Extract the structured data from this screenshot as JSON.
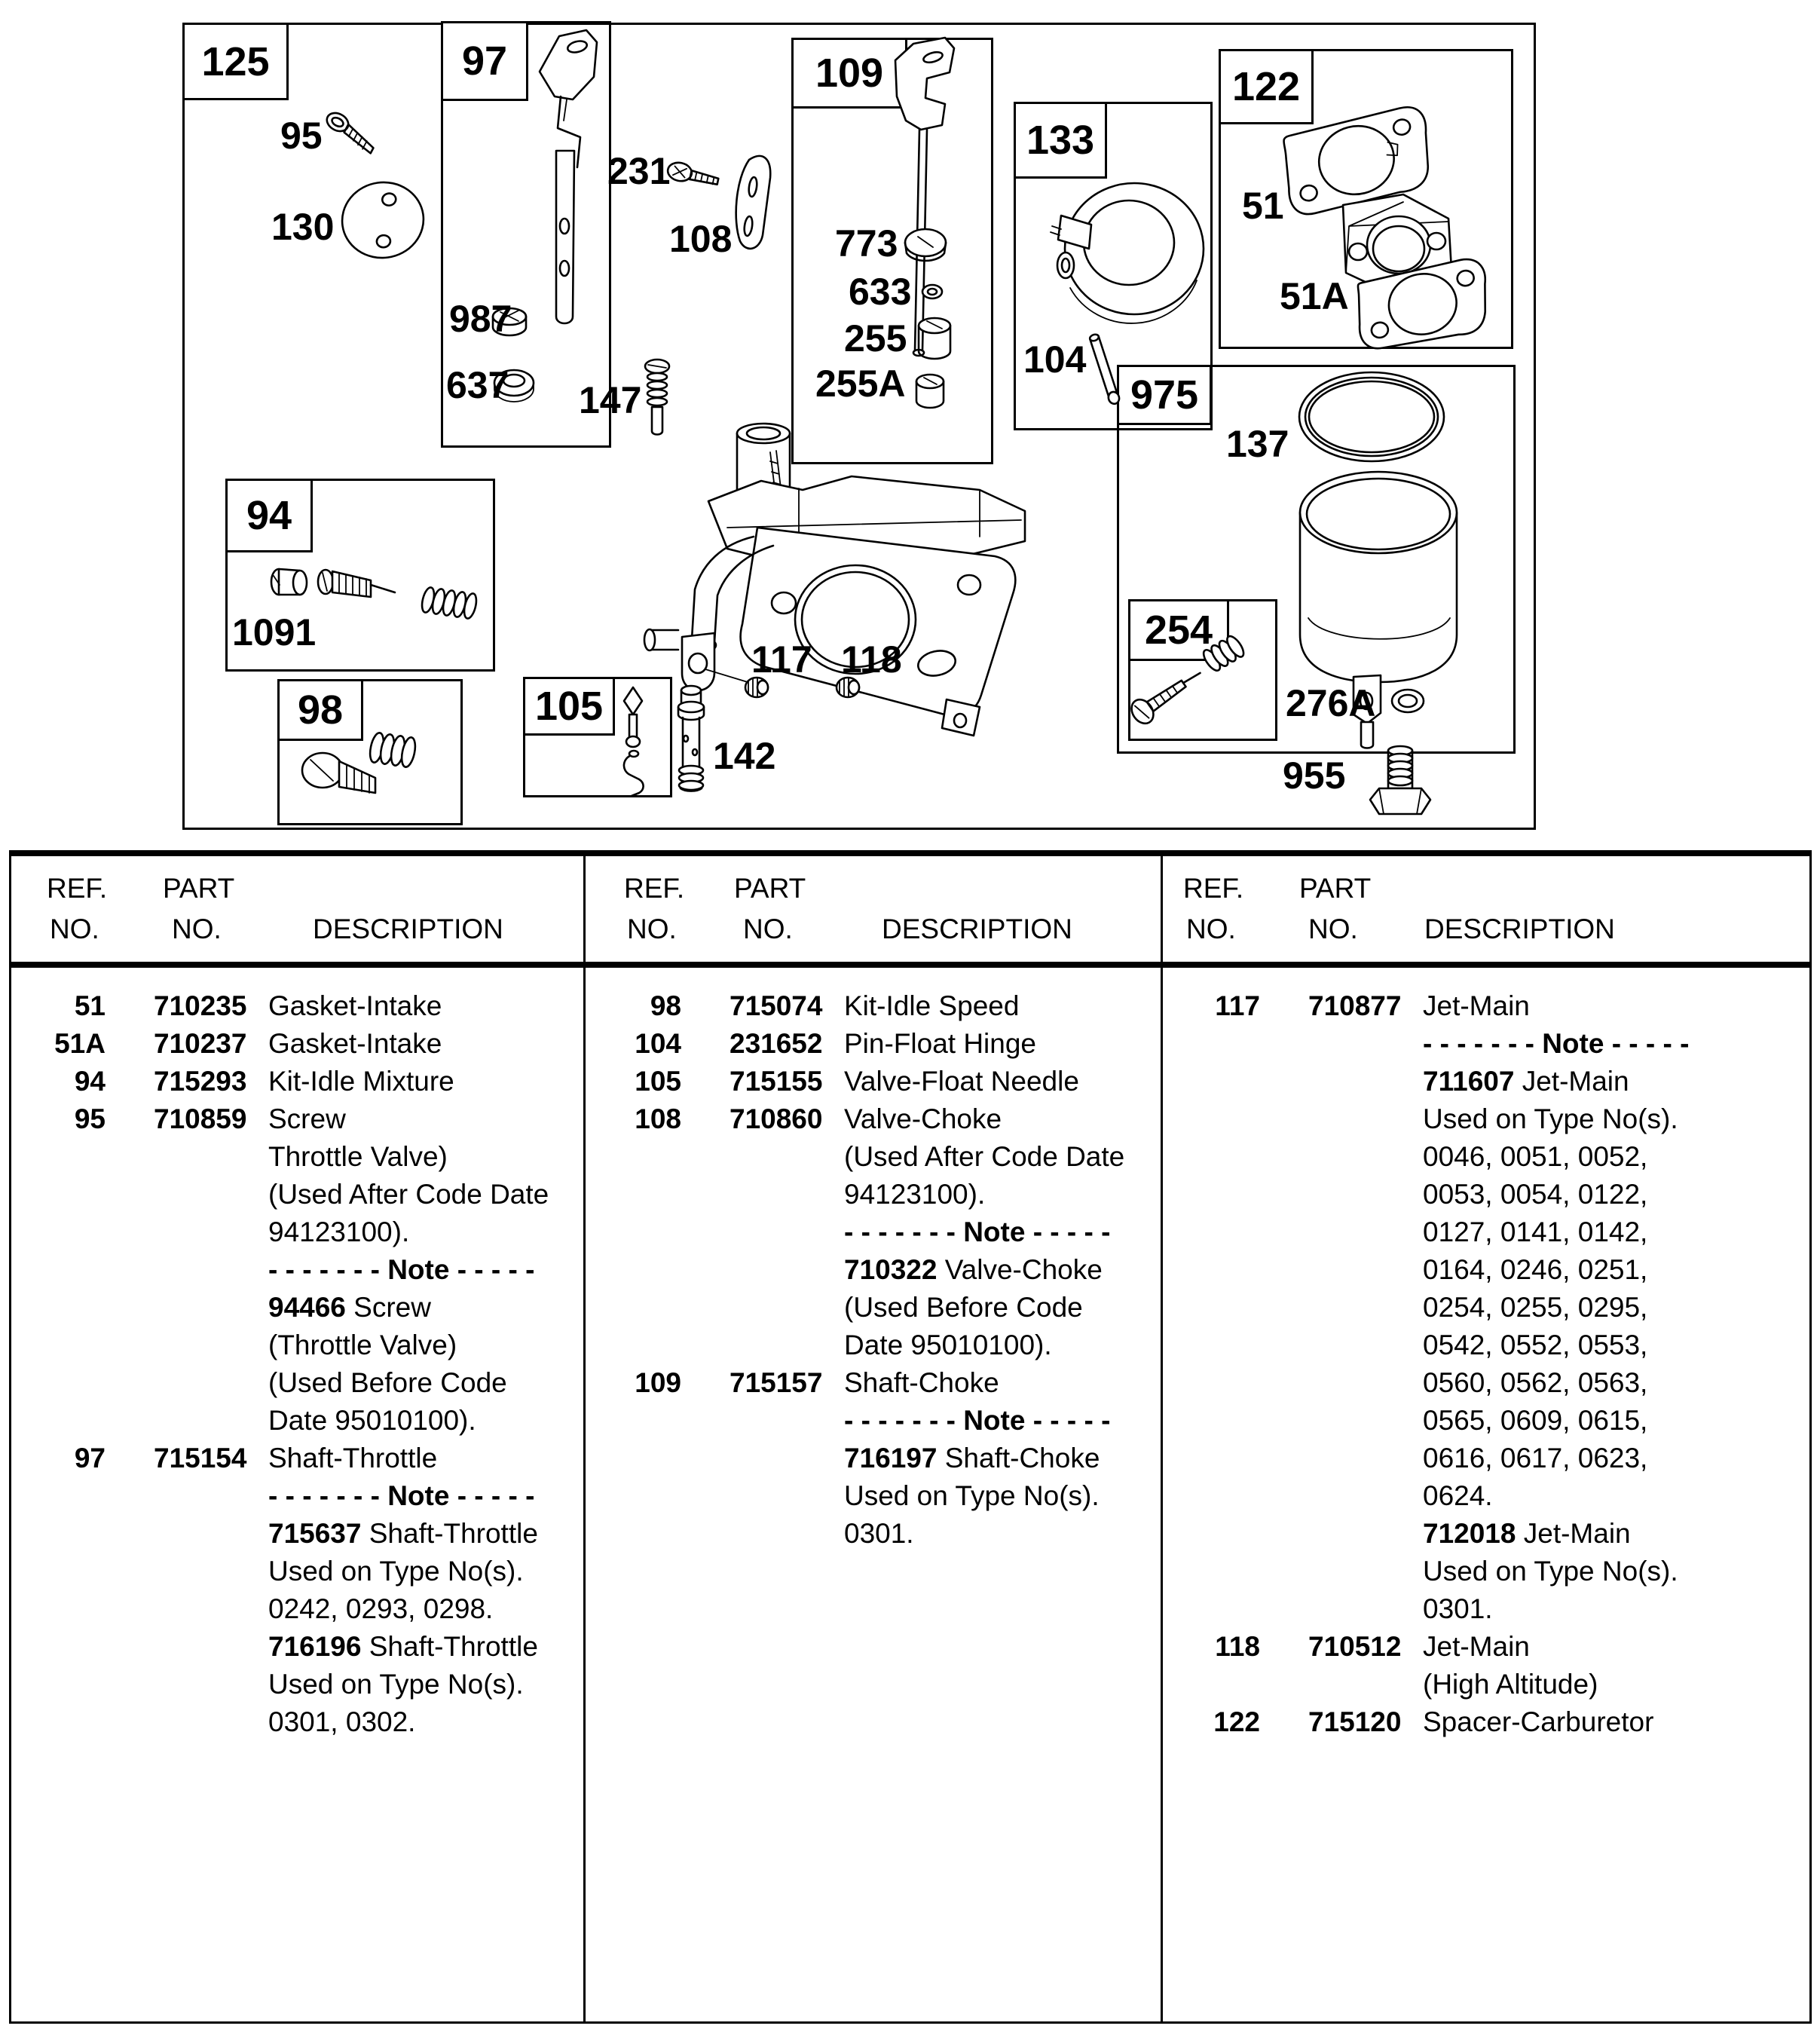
{
  "diagram": {
    "boxes": {
      "b125": "125",
      "b97": "97",
      "b109": "109",
      "b133": "133",
      "b122": "122",
      "b975": "975",
      "b254": "254",
      "b94": "94",
      "b98": "98",
      "b105": "105"
    },
    "labels": {
      "l95": "95",
      "l130": "130",
      "l987": "987",
      "l637": "637",
      "l231": "231",
      "l108": "108",
      "l773": "773",
      "l633": "633",
      "l255": "255",
      "l255a": "255A",
      "l104": "104",
      "l51": "51",
      "l51a": "51A",
      "l147": "147",
      "l1091": "1091",
      "l117": "117",
      "l118": "118",
      "l142": "142",
      "l137": "137",
      "l276a": "276A",
      "l955": "955"
    }
  },
  "table": {
    "headers": {
      "ref1": "REF.",
      "ref2": "NO.",
      "part1": "PART",
      "part2": "NO.",
      "desc": "DESCRIPTION"
    },
    "col1": [
      {
        "ref": "51",
        "part": "710235",
        "d": [
          {
            "t": "Gasket-Intake"
          }
        ]
      },
      {
        "ref": "51A",
        "part": "710237",
        "d": [
          {
            "t": "Gasket-Intake"
          }
        ]
      },
      {
        "ref": "94",
        "part": "715293",
        "d": [
          {
            "t": "Kit-Idle Mixture"
          }
        ]
      },
      {
        "ref": "95",
        "part": "710859",
        "d": [
          {
            "t": "Screw"
          }
        ]
      },
      {
        "d": [
          {
            "t": "Throttle Valve)"
          }
        ]
      },
      {
        "d": [
          {
            "t": "(Used After Code Date"
          }
        ]
      },
      {
        "d": [
          {
            "t": "94123100)."
          }
        ]
      },
      {
        "d": [
          {
            "t": "- - - - - - - Note - - - - -",
            "b": 1
          }
        ]
      },
      {
        "d": [
          {
            "t": "94466 ",
            "b": 1
          },
          {
            "t": "Screw"
          }
        ]
      },
      {
        "d": [
          {
            "t": "(Throttle Valve)"
          }
        ]
      },
      {
        "d": [
          {
            "t": "(Used Before Code"
          }
        ]
      },
      {
        "d": [
          {
            "t": "Date 95010100)."
          }
        ]
      },
      {
        "ref": "97",
        "part": "715154",
        "d": [
          {
            "t": "Shaft-Throttle"
          }
        ]
      },
      {
        "d": [
          {
            "t": "- - - - - - - Note - - - - -",
            "b": 1
          }
        ]
      },
      {
        "d": [
          {
            "t": "715637 ",
            "b": 1
          },
          {
            "t": "Shaft-Throttle"
          }
        ]
      },
      {
        "d": [
          {
            "t": "Used on Type No(s)."
          }
        ]
      },
      {
        "d": [
          {
            "t": "0242, 0293, 0298."
          }
        ]
      },
      {
        "d": [
          {
            "t": "716196 ",
            "b": 1
          },
          {
            "t": "Shaft-Throttle"
          }
        ]
      },
      {
        "d": [
          {
            "t": "Used on Type No(s)."
          }
        ]
      },
      {
        "d": [
          {
            "t": "0301, 0302."
          }
        ]
      }
    ],
    "col2": [
      {
        "ref": "98",
        "part": "715074",
        "d": [
          {
            "t": "Kit-Idle Speed"
          }
        ]
      },
      {
        "ref": "104",
        "part": "231652",
        "d": [
          {
            "t": "Pin-Float Hinge"
          }
        ]
      },
      {
        "ref": "105",
        "part": "715155",
        "d": [
          {
            "t": "Valve-Float Needle"
          }
        ]
      },
      {
        "ref": "108",
        "part": "710860",
        "d": [
          {
            "t": "Valve-Choke"
          }
        ]
      },
      {
        "d": [
          {
            "t": "(Used After Code Date"
          }
        ]
      },
      {
        "d": [
          {
            "t": "94123100)."
          }
        ]
      },
      {
        "d": [
          {
            "t": "- - - - - - - Note - - - - -",
            "b": 1
          }
        ]
      },
      {
        "d": [
          {
            "t": "710322 ",
            "b": 1
          },
          {
            "t": "Valve-Choke"
          }
        ]
      },
      {
        "d": [
          {
            "t": "(Used Before Code"
          }
        ]
      },
      {
        "d": [
          {
            "t": "Date 95010100)."
          }
        ]
      },
      {
        "ref": "109",
        "part": "715157",
        "d": [
          {
            "t": "Shaft-Choke"
          }
        ]
      },
      {
        "d": [
          {
            "t": "- - - - - - - Note - - - - -",
            "b": 1
          }
        ]
      },
      {
        "d": [
          {
            "t": "716197 ",
            "b": 1
          },
          {
            "t": "Shaft-Choke"
          }
        ]
      },
      {
        "d": [
          {
            "t": "Used on Type No(s)."
          }
        ]
      },
      {
        "d": [
          {
            "t": "0301."
          }
        ]
      }
    ],
    "col3": [
      {
        "ref": "117",
        "part": "710877",
        "d": [
          {
            "t": "Jet-Main"
          }
        ]
      },
      {
        "d": [
          {
            "t": "- - - - - - - Note - - - - -",
            "b": 1
          }
        ]
      },
      {
        "d": [
          {
            "t": "711607 ",
            "b": 1
          },
          {
            "t": "Jet-Main"
          }
        ]
      },
      {
        "d": [
          {
            "t": "Used on Type No(s)."
          }
        ]
      },
      {
        "d": [
          {
            "t": "0046, 0051, 0052,"
          }
        ]
      },
      {
        "d": [
          {
            "t": "0053, 0054, 0122,"
          }
        ]
      },
      {
        "d": [
          {
            "t": "0127, 0141, 0142,"
          }
        ]
      },
      {
        "d": [
          {
            "t": "0164, 0246, 0251,"
          }
        ]
      },
      {
        "d": [
          {
            "t": "0254, 0255, 0295,"
          }
        ]
      },
      {
        "d": [
          {
            "t": "0542, 0552, 0553,"
          }
        ]
      },
      {
        "d": [
          {
            "t": "0560, 0562, 0563,"
          }
        ]
      },
      {
        "d": [
          {
            "t": "0565, 0609, 0615,"
          }
        ]
      },
      {
        "d": [
          {
            "t": "0616, 0617, 0623,"
          }
        ]
      },
      {
        "d": [
          {
            "t": "0624."
          }
        ]
      },
      {
        "d": [
          {
            "t": "712018 ",
            "b": 1
          },
          {
            "t": "Jet-Main"
          }
        ]
      },
      {
        "d": [
          {
            "t": "Used on Type No(s)."
          }
        ]
      },
      {
        "d": [
          {
            "t": "0301."
          }
        ]
      },
      {
        "ref": "118",
        "part": "710512",
        "d": [
          {
            "t": "Jet-Main"
          }
        ]
      },
      {
        "d": [
          {
            "t": "(High Altitude)"
          }
        ]
      },
      {
        "ref": "122",
        "part": "715120",
        "d": [
          {
            "t": "Spacer-Carburetor"
          }
        ]
      }
    ]
  }
}
